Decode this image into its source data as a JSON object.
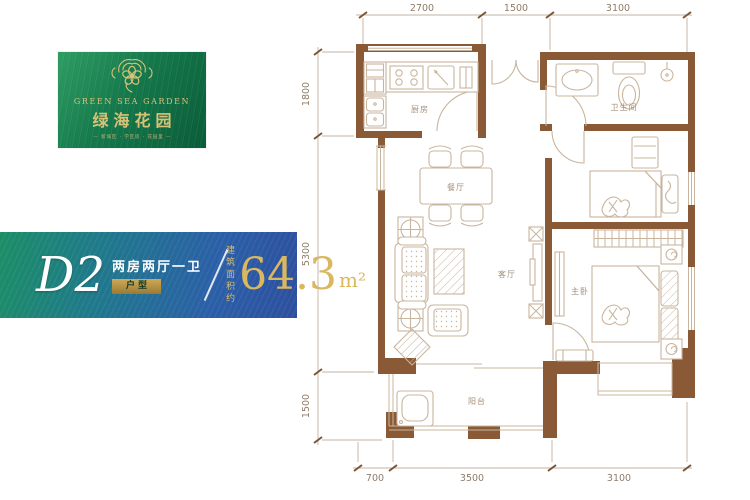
{
  "logo": {
    "title_en": "GREEN SEA GARDEN",
    "title_zh": "绿海花园",
    "tagline": "— 新城区 · 学区房 · 花园里 —"
  },
  "banner": {
    "unit_code": "D2",
    "layout_desc": "两房两厅一卫",
    "type_label": "户型",
    "area_prefix_line1": "建筑",
    "area_prefix_line2": "面积约",
    "area_value": "64.3",
    "area_unit": "m²"
  },
  "floorplan": {
    "rooms": {
      "kitchen": "厨房",
      "dining": "餐厅",
      "bathroom": "卫生间",
      "living": "客厅",
      "master_bedroom": "主卧",
      "balcony": "阳台"
    },
    "dims": {
      "top": [
        "2700",
        "1500",
        "3100"
      ],
      "left": [
        "1800",
        "5300",
        "1500"
      ],
      "bottom": [
        "700",
        "3500",
        "3100"
      ]
    }
  },
  "colors": {
    "wall": "#8a5a36",
    "furniture_line": "#c9b59e",
    "room_label": "#a5907c",
    "dim_text": "#8f7c68",
    "logo_gold": "#d9c277",
    "banner_gold": "#d9b860",
    "logo_green": "#15794c",
    "banner_blue": "#2b5fa8"
  }
}
